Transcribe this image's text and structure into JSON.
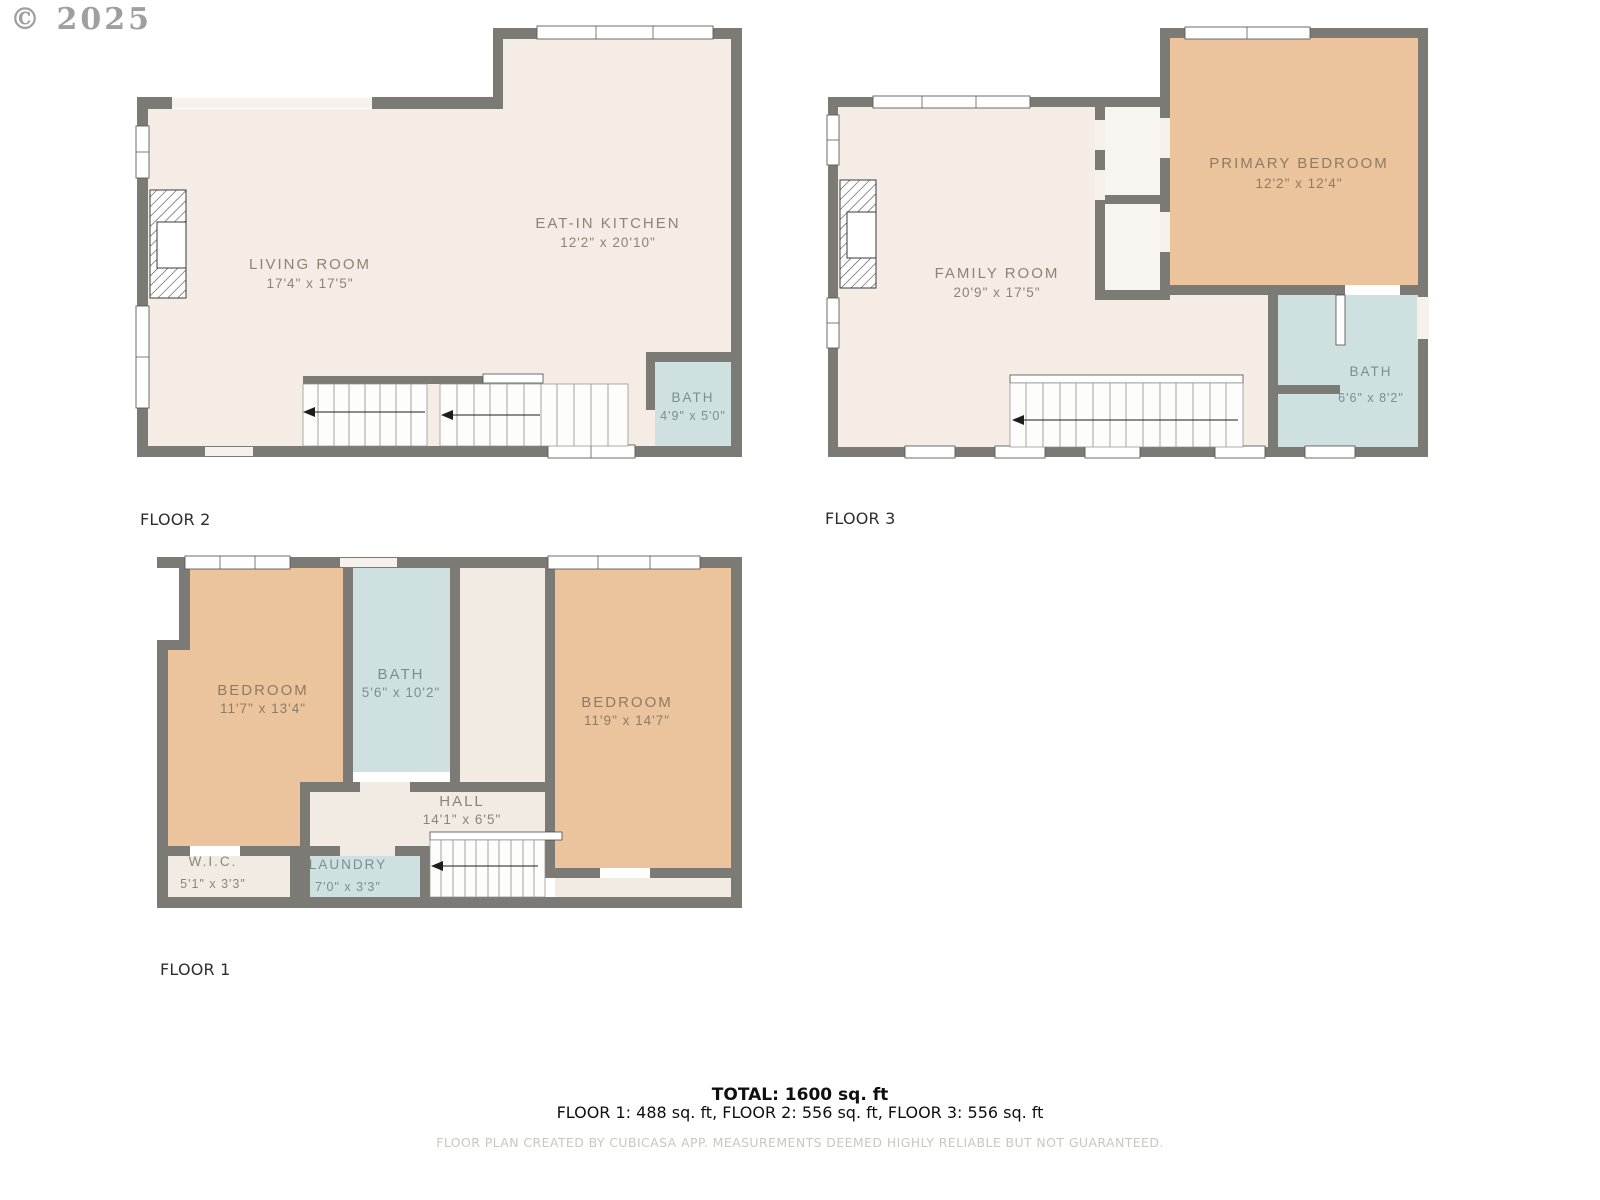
{
  "watermark": "© 2025",
  "palette": {
    "wall": "#7c7a75",
    "floor_beige": "#f4ece5",
    "room_orange": "#ebc49e",
    "room_blue": "#cfe0e1",
    "label_text": "#8d8477",
    "label_text_orange_room": "#8d7b64",
    "label_text_blue_room": "#7e8d90",
    "caption_text": "#2e2e2e",
    "footer_text": "#c9c7c3",
    "window_fill": "#ffffff"
  },
  "floors": [
    {
      "label": "FLOOR 1",
      "rooms": [
        {
          "name": "BEDROOM",
          "dims": "11'7\" x 13'4\""
        },
        {
          "name": "BATH",
          "dims": "5'6\" x 10'2\""
        },
        {
          "name": "BEDROOM",
          "dims": "11'9\" x 14'7\""
        },
        {
          "name": "HALL",
          "dims": "14'1\" x 6'5\""
        },
        {
          "name": "W.I.C.",
          "dims": "5'1\" x 3'3\""
        },
        {
          "name": "LAUNDRY",
          "dims": "7'0\" x 3'3\""
        }
      ]
    },
    {
      "label": "FLOOR 2",
      "rooms": [
        {
          "name": "LIVING ROOM",
          "dims": "17'4\" x 17'5\""
        },
        {
          "name": "EAT-IN KITCHEN",
          "dims": "12'2\" x 20'10\""
        },
        {
          "name": "BATH",
          "dims": "4'9\" x 5'0\""
        }
      ]
    },
    {
      "label": "FLOOR 3",
      "rooms": [
        {
          "name": "FAMILY ROOM",
          "dims": "20'9\" x 17'5\""
        },
        {
          "name": "PRIMARY BEDROOM",
          "dims": "12'2\" x 12'4\""
        },
        {
          "name": "BATH",
          "dims": "6'6\" x 8'2\""
        }
      ]
    }
  ],
  "summary": {
    "total": "TOTAL: 1600 sq. ft",
    "breakdown": "FLOOR 1: 488 sq. ft, FLOOR 2: 556 sq. ft, FLOOR 3: 556 sq. ft"
  },
  "footer": "FLOOR PLAN CREATED BY CUBICASA APP. MEASUREMENTS DEEMED HIGHLY RELIABLE BUT NOT GUARANTEED."
}
